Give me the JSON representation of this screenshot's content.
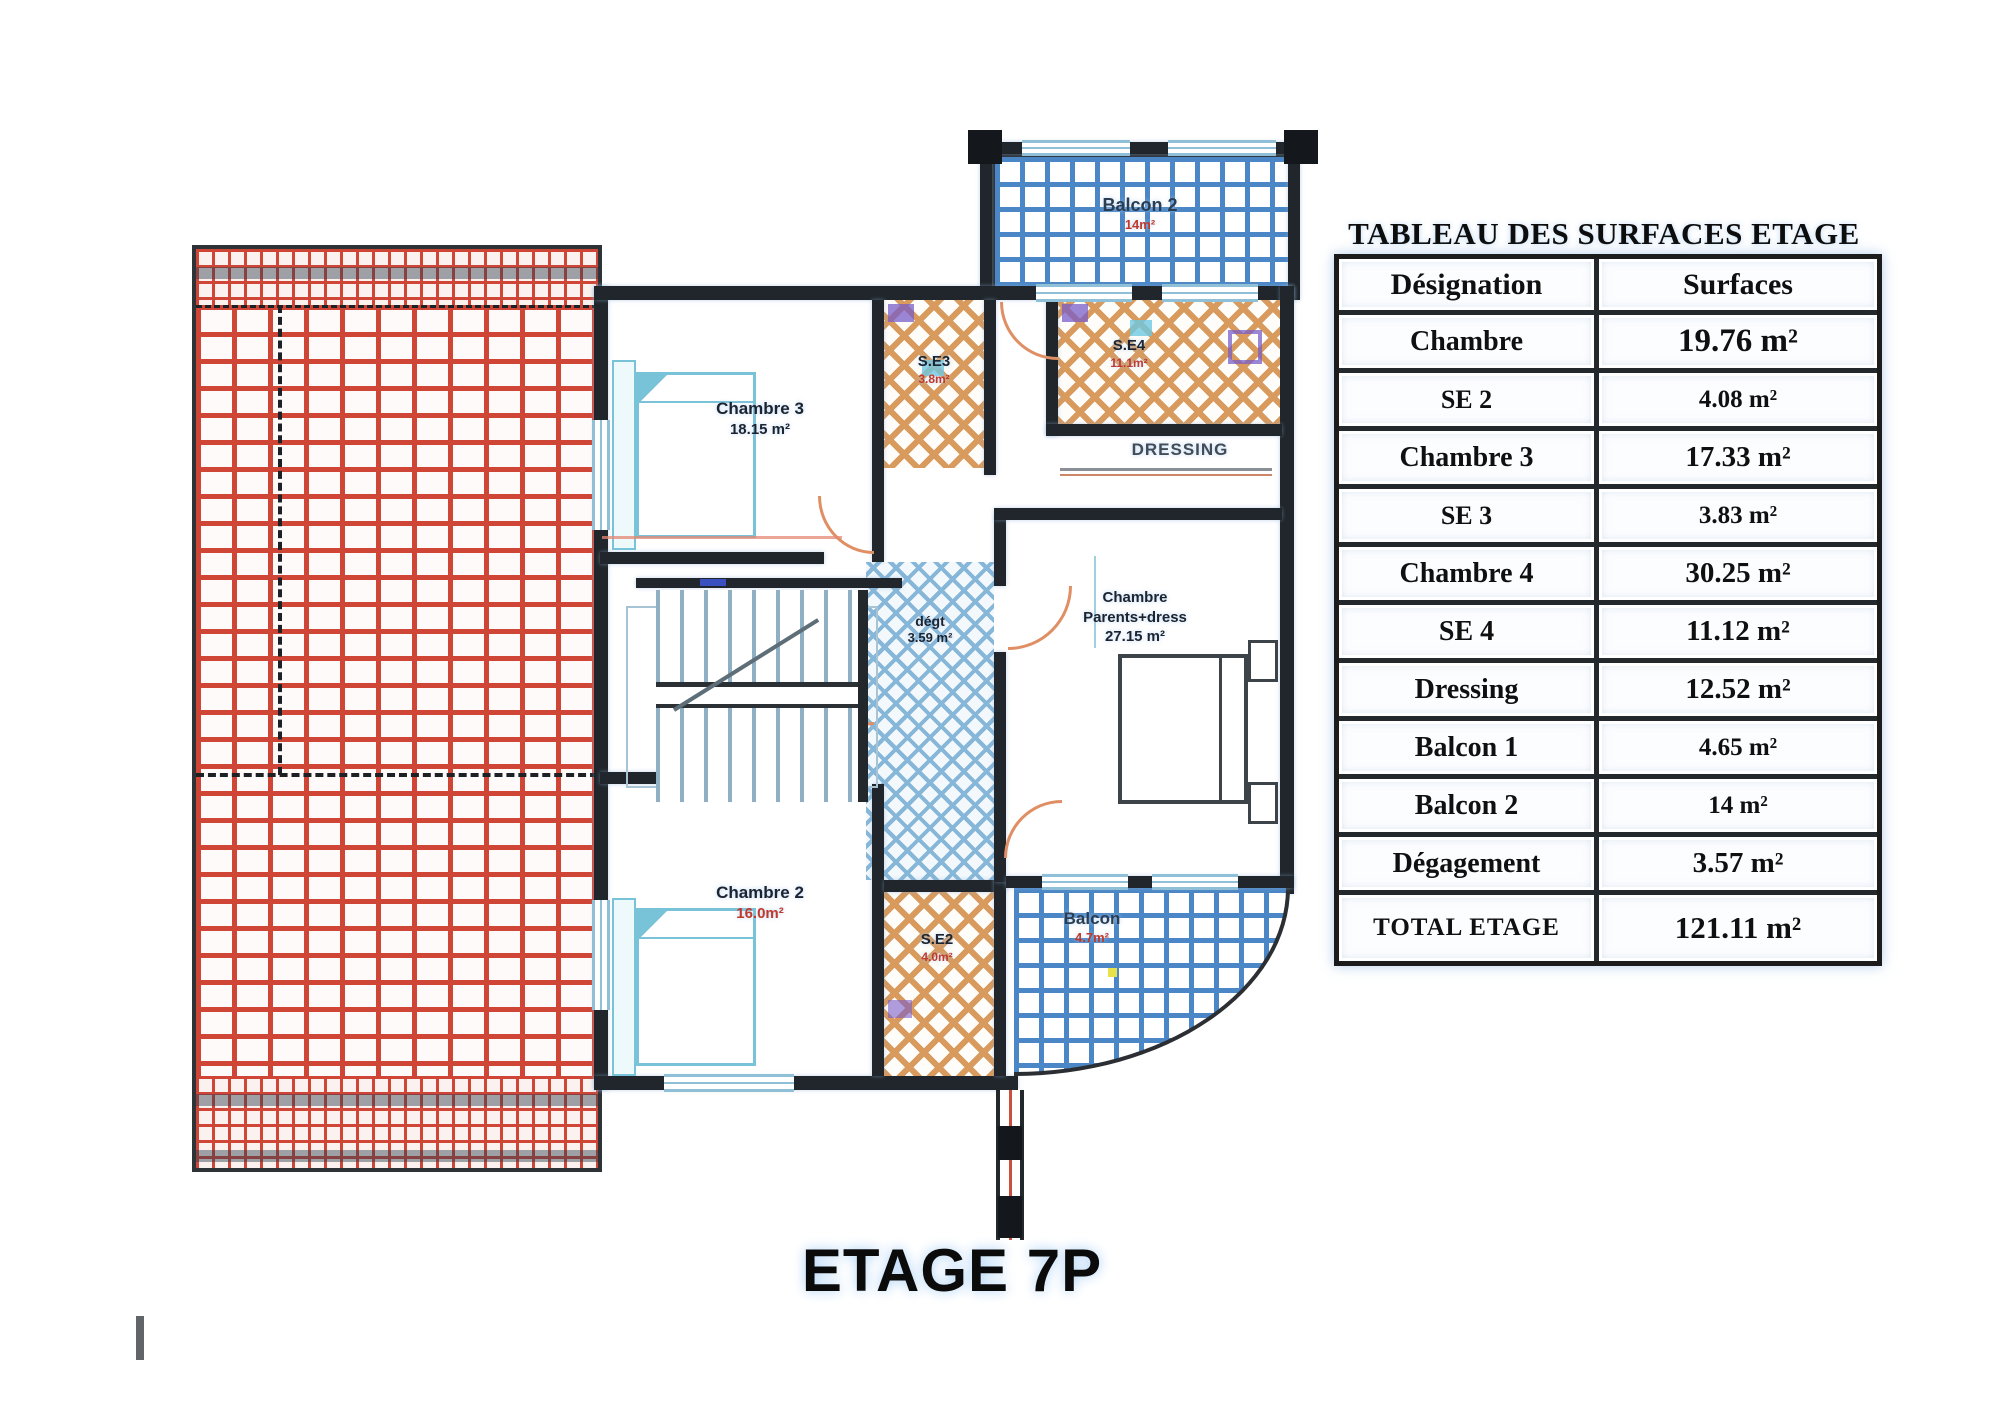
{
  "title": "ETAGE 7P",
  "table": {
    "title": "TABLEAU DES SURFACES ETAGE",
    "columns": [
      "Désignation",
      "Surfaces"
    ],
    "rows": [
      {
        "designation": "Chambre",
        "surface": "19.76 m²"
      },
      {
        "designation": "SE 2",
        "surface": "4.08 m²"
      },
      {
        "designation": "Chambre 3",
        "surface": "17.33 m²"
      },
      {
        "designation": "SE 3",
        "surface": "3.83 m²"
      },
      {
        "designation": "Chambre 4",
        "surface": "30.25 m²"
      },
      {
        "designation": "SE 4",
        "surface": "11.12 m²"
      },
      {
        "designation": "Dressing",
        "surface": "12.52 m²"
      },
      {
        "designation": "Balcon 1",
        "surface": "4.65 m²"
      },
      {
        "designation": "Balcon 2",
        "surface": "14 m²"
      },
      {
        "designation": "Dégagement",
        "surface": "3.57 m²"
      }
    ],
    "total": {
      "designation": "TOTAL ETAGE",
      "surface": "121.11 m²"
    }
  },
  "plan": {
    "rooms": {
      "chambre3": {
        "label": "Chambre 3",
        "area": "18.15 m²"
      },
      "chambre2": {
        "label": "Chambre 2",
        "area": "16.0m²"
      },
      "chambre_parents": {
        "line1": "Chambre",
        "line2": "Parents+dress",
        "area": "27.15 m²"
      },
      "degagement": {
        "label": "dégt",
        "area": "3.59 m²"
      },
      "dressing": {
        "label": "DRESSING"
      },
      "se3": {
        "label": "S.E3",
        "area": "3.8m²"
      },
      "se4": {
        "label": "S.E4",
        "area": "11.1m²"
      },
      "se2": {
        "label": "S.E2",
        "area": "4.0m²"
      },
      "balcon2": {
        "label": "Balcon 2",
        "area": "14m²"
      },
      "balcon": {
        "label": "Balcon",
        "area": "4.7m²"
      }
    }
  },
  "palette": {
    "wall": "#20262b",
    "brick_red": "#cf4637",
    "balcony_blue": "#4b87c6",
    "sanitary_tan": "#d89a5d",
    "corridor_hatch_blue": "#86b6d8",
    "furniture_cyan": "#79c3d8",
    "door_orange": "#df8f63",
    "area_red": "#c0392b"
  },
  "chart_data": {
    "type": "table",
    "title": "TABLEAU DES SURFACES ETAGE",
    "columns": [
      "Désignation",
      "Surfaces"
    ],
    "categories": [
      "Chambre",
      "SE 2",
      "Chambre 3",
      "SE 3",
      "Chambre 4",
      "SE 4",
      "Dressing",
      "Balcon 1",
      "Balcon 2",
      "Dégagement",
      "TOTAL ETAGE"
    ],
    "values": [
      19.76,
      4.08,
      17.33,
      3.83,
      30.25,
      11.12,
      12.52,
      4.65,
      14,
      3.57,
      121.11
    ],
    "unit": "m²"
  }
}
